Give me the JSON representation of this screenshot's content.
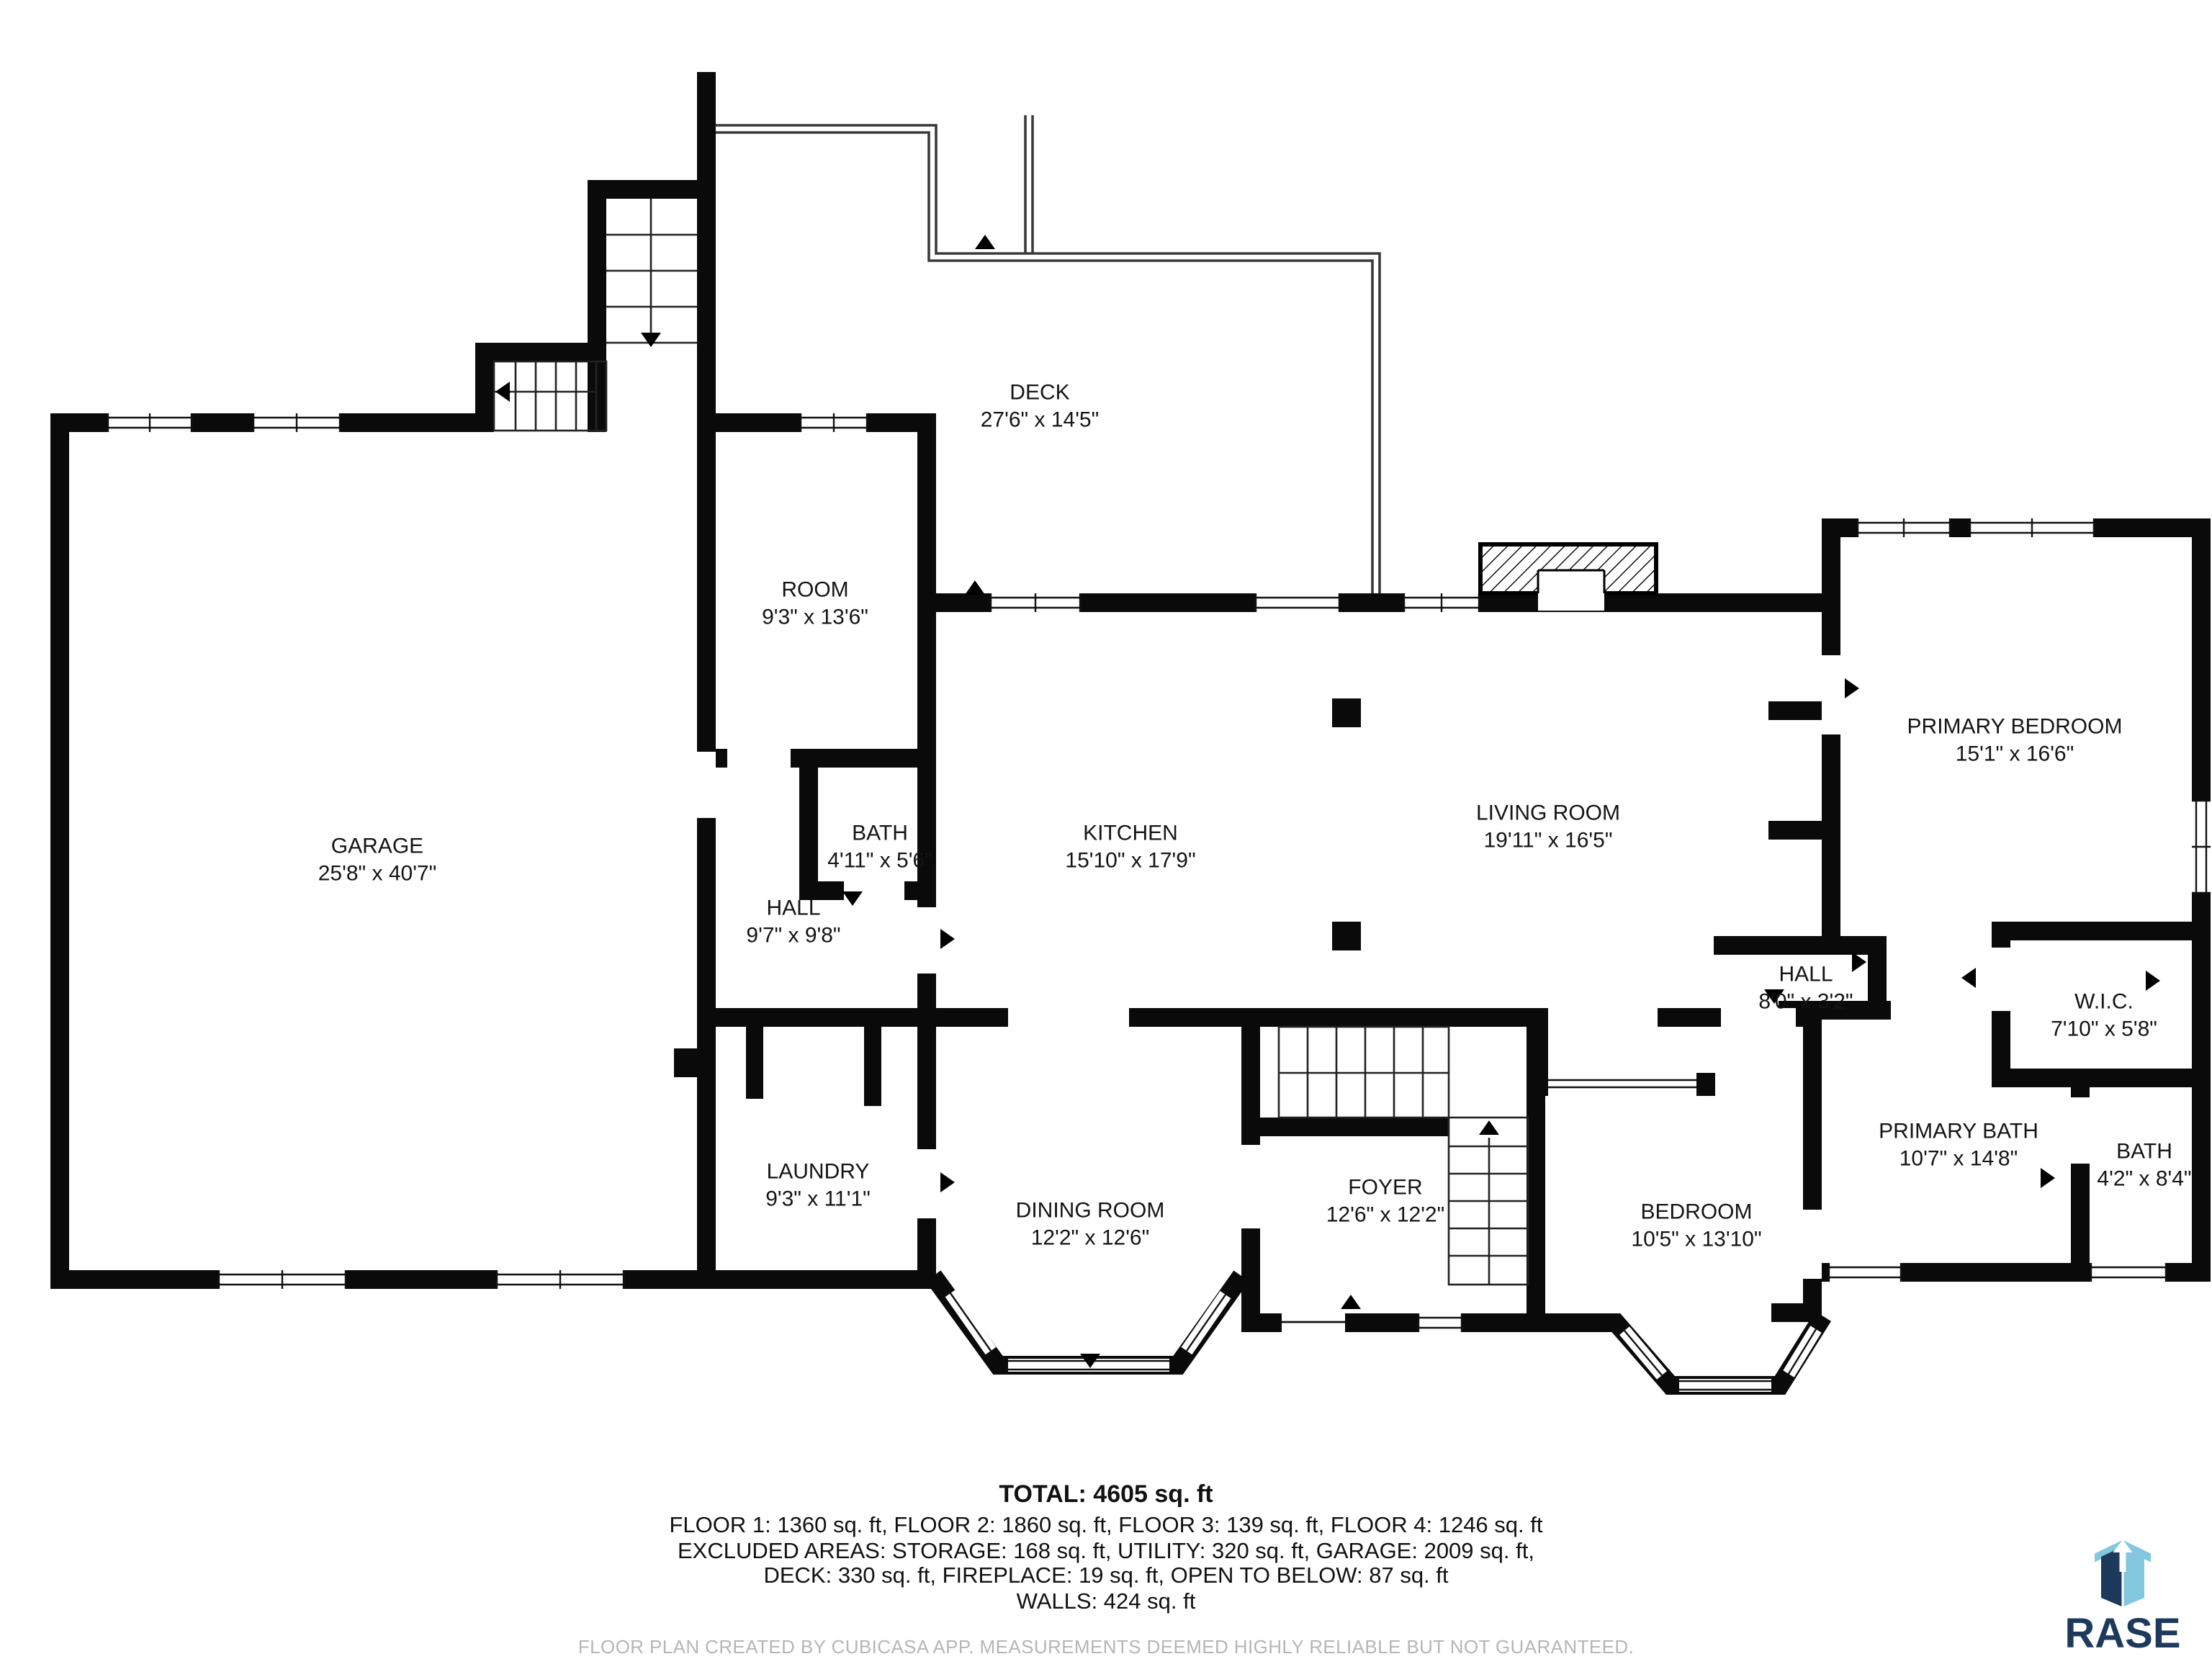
{
  "rooms": [
    {
      "name": "GARAGE",
      "dims": "25'8\" x 40'7\""
    },
    {
      "name": "DECK",
      "dims": "27'6\" x 14'5\""
    },
    {
      "name": "ROOM",
      "dims": "9'3\" x 13'6\""
    },
    {
      "name": "BATH",
      "dims": "4'11\" x 5'6\""
    },
    {
      "name": "HALL",
      "dims": "9'7\" x 9'8\""
    },
    {
      "name": "KITCHEN",
      "dims": "15'10\" x 17'9\""
    },
    {
      "name": "LIVING ROOM",
      "dims": "19'11\" x 16'5\""
    },
    {
      "name": "PRIMARY BEDROOM",
      "dims": "15'1\" x 16'6\""
    },
    {
      "name": "HALL",
      "dims": "8'0\" x 3'2\""
    },
    {
      "name": "W.I.C.",
      "dims": "7'10\" x 5'8\""
    },
    {
      "name": "LAUNDRY",
      "dims": "9'3\" x 11'1\""
    },
    {
      "name": "DINING ROOM",
      "dims": "12'2\" x 12'6\""
    },
    {
      "name": "FOYER",
      "dims": "12'6\" x 12'2\""
    },
    {
      "name": "BEDROOM",
      "dims": "10'5\" x 13'10\""
    },
    {
      "name": "PRIMARY BATH",
      "dims": "10'7\" x 14'8\""
    },
    {
      "name": "BATH",
      "dims": "4'2\" x 8'4\""
    }
  ],
  "summary": {
    "total": "TOTAL: 4605 sq. ft",
    "line1": "FLOOR 1: 1360 sq. ft, FLOOR 2: 1860 sq. ft, FLOOR 3: 139 sq. ft, FLOOR 4: 1246 sq. ft",
    "line2": "EXCLUDED AREAS: STORAGE: 168 sq. ft, UTILITY: 320 sq. ft, GARAGE: 2009 sq. ft,",
    "line3": "DECK: 330 sq. ft, FIREPLACE: 19 sq. ft, OPEN TO BELOW: 87 sq. ft",
    "line4": "WALLS: 424 sq. ft"
  },
  "disclaimer": "FLOOR PLAN CREATED BY CUBICASA APP. MEASUREMENTS DEEMED HIGHLY RELIABLE BUT NOT GUARANTEED.",
  "logo": {
    "text": "RASE",
    "navy": "#1d3a5c",
    "light_blue": "#82c7de",
    "white": "#ffffff"
  },
  "colors": {
    "wall": "#0a0a0a",
    "thin_line": "#333333",
    "disclaimer_gray": "#b6b6b6"
  }
}
